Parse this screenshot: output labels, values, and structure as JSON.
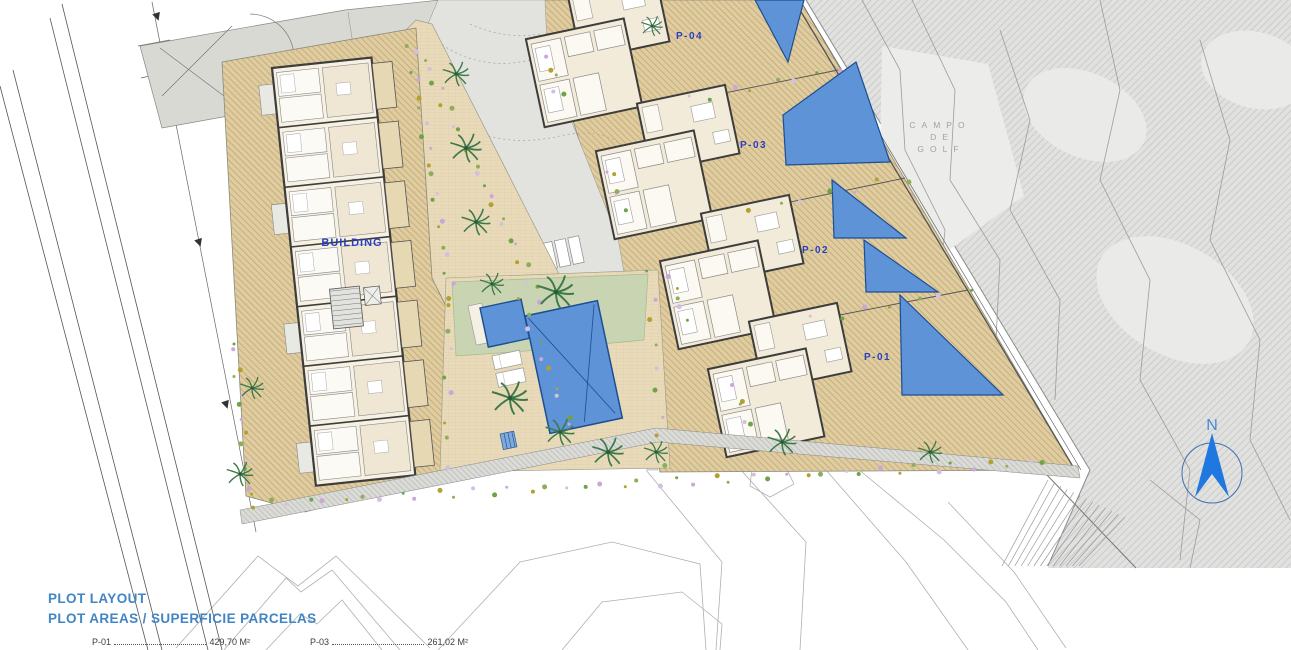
{
  "legend": {
    "title": "PLOT LAYOUT",
    "subtitle": "PLOT AREAS / SUPERFICIE PARCELAS",
    "entries": [
      {
        "plot": "P-01",
        "area": "429,70 M²"
      },
      {
        "plot": "P-03",
        "area": "261,02 M²"
      }
    ]
  },
  "plan": {
    "building_label": "BUILDING",
    "plot_labels": [
      "P-04",
      "P-03",
      "P-02",
      "P-01"
    ],
    "golf_course_label_lines": [
      "CAMPO",
      "DE",
      "GOLF"
    ],
    "north_label": "N"
  },
  "colors": {
    "plot_label_blue": "#2b3fbf",
    "legend_blue": "#4285c4",
    "pool_blue": "#5e93d8",
    "pool_edge_blue": "#1d4e8f",
    "terrace_tan": "#dfcc9f",
    "golf_gray": "#e1e1e0",
    "north_arrow_blue": "#1f78e0"
  }
}
